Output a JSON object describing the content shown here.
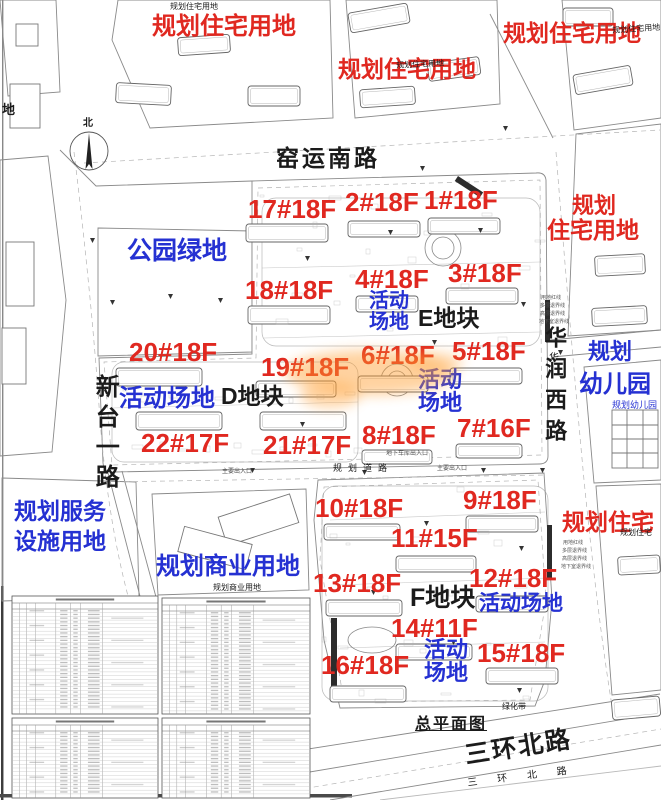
{
  "document": {
    "type": "site-plan",
    "title": "总平面图"
  },
  "colors": {
    "red": "#e02820",
    "blue": "#2531d2",
    "black": "#1b1b1b",
    "gray": "#555555",
    "orange_watermark": "#ff9d2e",
    "linework": "#8a8a8a"
  },
  "compass": {
    "label": "北"
  },
  "labels": [
    {
      "n": "land-use-residential-top-left",
      "t": "规划住宅用地",
      "x": 152,
      "y": 14,
      "s": 24,
      "c": "red"
    },
    {
      "n": "land-use-residential-top-center",
      "t": "规划住宅用地",
      "x": 338,
      "y": 57,
      "s": 23,
      "c": "red"
    },
    {
      "n": "land-use-residential-top-right",
      "t": "规划住宅用地",
      "x": 503,
      "y": 21,
      "s": 23,
      "c": "red"
    },
    {
      "n": "land-use-residential-right-line1",
      "t": "规划",
      "x": 572,
      "y": 194,
      "s": 22,
      "c": "red"
    },
    {
      "n": "land-use-residential-right-line2",
      "t": "住宅用地",
      "x": 547,
      "y": 218,
      "s": 23,
      "c": "red"
    },
    {
      "n": "land-use-residential-bottom-right",
      "t": "规划住宅",
      "x": 562,
      "y": 510,
      "s": 23,
      "c": "red"
    },
    {
      "n": "land-use-park-green",
      "t": "公园绿地",
      "x": 127,
      "y": 238,
      "s": 25,
      "c": "blue"
    },
    {
      "n": "activity-area-e-upper",
      "t": "活动\n场地",
      "x": 369,
      "y": 291,
      "s": 20,
      "c": "blue"
    },
    {
      "n": "activity-area-center",
      "t": "活动\n场地",
      "x": 418,
      "y": 368,
      "s": 22,
      "c": "blue"
    },
    {
      "n": "activity-area-d",
      "t": "活动场地",
      "x": 119,
      "y": 386,
      "s": 24,
      "c": "blue"
    },
    {
      "n": "planned-kindergarten-line1",
      "t": "规划",
      "x": 588,
      "y": 340,
      "s": 22,
      "c": "blue"
    },
    {
      "n": "planned-kindergarten-line2",
      "t": "幼儿园",
      "x": 579,
      "y": 372,
      "s": 24,
      "c": "blue"
    },
    {
      "n": "planned-kindergarten-small",
      "t": "规划幼儿园",
      "x": 612,
      "y": 401,
      "s": 9,
      "c": "blue",
      "w": false
    },
    {
      "n": "land-use-service-facilities",
      "t": "规划服务\n设施用地",
      "x": 14,
      "y": 496,
      "s": 23,
      "c": "blue",
      "lh": 30
    },
    {
      "n": "land-use-commercial",
      "t": "规划商业用地",
      "x": 156,
      "y": 554,
      "s": 24,
      "c": "blue"
    },
    {
      "n": "activity-area-f-right",
      "t": "活动场地",
      "x": 479,
      "y": 593,
      "s": 21,
      "c": "blue"
    },
    {
      "n": "activity-area-f-bottom",
      "t": "活动\n场地",
      "x": 424,
      "y": 638,
      "s": 22,
      "c": "blue"
    },
    {
      "n": "building-label-17",
      "t": "17#18F",
      "x": 248,
      "y": 196,
      "s": 26,
      "c": "red"
    },
    {
      "n": "building-label-2",
      "t": "2#18F",
      "x": 345,
      "y": 189,
      "s": 26,
      "c": "red"
    },
    {
      "n": "building-label-1",
      "t": "1#18F",
      "x": 424,
      "y": 187,
      "s": 26,
      "c": "red"
    },
    {
      "n": "building-label-18",
      "t": "18#18F",
      "x": 245,
      "y": 277,
      "s": 26,
      "c": "red"
    },
    {
      "n": "building-label-4",
      "t": "4#18F",
      "x": 355,
      "y": 266,
      "s": 26,
      "c": "red"
    },
    {
      "n": "building-label-3",
      "t": "3#18F",
      "x": 448,
      "y": 260,
      "s": 26,
      "c": "red"
    },
    {
      "n": "building-label-20",
      "t": "20#18F",
      "x": 129,
      "y": 339,
      "s": 26,
      "c": "red"
    },
    {
      "n": "building-label-19",
      "t": "19#18F",
      "x": 261,
      "y": 354,
      "s": 26,
      "c": "red"
    },
    {
      "n": "building-label-6",
      "t": "6#18F",
      "x": 361,
      "y": 342,
      "s": 26,
      "c": "red"
    },
    {
      "n": "building-label-5",
      "t": "5#18F",
      "x": 452,
      "y": 338,
      "s": 26,
      "c": "red"
    },
    {
      "n": "building-label-22",
      "t": "22#17F",
      "x": 141,
      "y": 430,
      "s": 26,
      "c": "red"
    },
    {
      "n": "building-label-21",
      "t": "21#17F",
      "x": 263,
      "y": 432,
      "s": 26,
      "c": "red"
    },
    {
      "n": "building-label-8",
      "t": "8#18F",
      "x": 362,
      "y": 422,
      "s": 26,
      "c": "red"
    },
    {
      "n": "building-label-7",
      "t": "7#16F",
      "x": 457,
      "y": 415,
      "s": 26,
      "c": "red"
    },
    {
      "n": "building-label-9",
      "t": "9#18F",
      "x": 463,
      "y": 487,
      "s": 26,
      "c": "red"
    },
    {
      "n": "building-label-10",
      "t": "10#18F",
      "x": 315,
      "y": 495,
      "s": 26,
      "c": "red"
    },
    {
      "n": "building-label-11",
      "t": "11#15F",
      "x": 391,
      "y": 525,
      "s": 26,
      "c": "red"
    },
    {
      "n": "building-label-12",
      "t": "12#18F",
      "x": 469,
      "y": 565,
      "s": 26,
      "c": "red"
    },
    {
      "n": "building-label-13",
      "t": "13#18F",
      "x": 313,
      "y": 570,
      "s": 26,
      "c": "red"
    },
    {
      "n": "building-label-14",
      "t": "14#11F",
      "x": 391,
      "y": 615,
      "s": 26,
      "c": "red"
    },
    {
      "n": "building-label-15",
      "t": "15#18F",
      "x": 477,
      "y": 640,
      "s": 26,
      "c": "red"
    },
    {
      "n": "building-label-16",
      "t": "16#18F",
      "x": 321,
      "y": 652,
      "s": 26,
      "c": "red"
    },
    {
      "n": "road-yaoyun-south",
      "t": "窑运南路",
      "x": 276,
      "y": 146,
      "s": 23,
      "c": "black",
      "ls": 3
    },
    {
      "n": "block-e",
      "t": "E地块",
      "x": 418,
      "y": 306,
      "s": 23,
      "c": "black"
    },
    {
      "n": "block-d",
      "t": "D地块",
      "x": 221,
      "y": 384,
      "s": 23,
      "c": "black"
    },
    {
      "n": "block-f",
      "t": "F地块",
      "x": 410,
      "y": 585,
      "s": 25,
      "c": "black"
    },
    {
      "n": "road-xintai-first",
      "t": "新台一路",
      "x": 92,
      "y": 374,
      "s": 24,
      "c": "black",
      "vert": true,
      "ls": 6
    },
    {
      "n": "road-huarun-west",
      "t": "华润西路",
      "x": 543,
      "y": 326,
      "s": 22,
      "c": "black",
      "vert": true,
      "ls": 9
    },
    {
      "n": "road-huarun-west-small",
      "t": "华",
      "x": 549,
      "y": 354,
      "s": 10,
      "c": "black",
      "w": false
    },
    {
      "n": "road-sanhuan-north",
      "t": "三环北路",
      "x": 463,
      "y": 743,
      "s": 25,
      "c": "black",
      "ls": 2,
      "rot": -9
    },
    {
      "n": "road-sanhuan-north-small",
      "t": "三环北路",
      "x": 467,
      "y": 779,
      "s": 10,
      "c": "black",
      "ls": 20,
      "rot": -7,
      "w": false
    },
    {
      "n": "plan-title",
      "t": "总平面图",
      "x": 415,
      "y": 717,
      "s": 16,
      "c": "black",
      "ls": 2,
      "u": true
    },
    {
      "n": "green-belt",
      "t": "绿化带",
      "x": 502,
      "y": 703,
      "s": 8,
      "c": "black",
      "w": false
    },
    {
      "n": "road-planned-label",
      "t": "规划道路",
      "x": 333,
      "y": 464,
      "s": 9,
      "c": "black",
      "ls": 6,
      "w": false
    },
    {
      "n": "commercial-small-label",
      "t": "规划商业用地",
      "x": 213,
      "y": 584,
      "s": 8,
      "c": "black",
      "w": false
    },
    {
      "n": "residential-small-top",
      "t": "规划住宅用地",
      "x": 170,
      "y": 3,
      "s": 8,
      "c": "black",
      "w": false
    },
    {
      "n": "residential-small-top-center",
      "t": "规划住宅用地",
      "x": 396,
      "y": 62,
      "s": 8,
      "c": "black",
      "w": false,
      "rot": -3
    },
    {
      "n": "residential-small-top-right",
      "t": "规划住宅用地",
      "x": 612,
      "y": 27,
      "s": 8,
      "c": "black",
      "w": false,
      "rot": -4
    },
    {
      "n": "residential-small-right",
      "t": "规划住宅",
      "x": 620,
      "y": 529,
      "s": 8,
      "c": "black",
      "w": false
    },
    {
      "n": "cut-label-left",
      "t": "地",
      "x": 2,
      "y": 103,
      "s": 13,
      "c": "black"
    },
    {
      "n": "entrance-annotation-1",
      "t": "主要出入口",
      "x": 437,
      "y": 466,
      "s": 6,
      "c": "gray",
      "w": false
    },
    {
      "n": "entrance-annotation-2",
      "t": "地下车库出入口",
      "x": 386,
      "y": 451,
      "s": 6,
      "c": "gray",
      "w": false
    },
    {
      "n": "entrance-annotation-3",
      "t": "主要出入口",
      "x": 222,
      "y": 469,
      "s": 6,
      "c": "gray",
      "w": false
    },
    {
      "n": "redline-annotation-1",
      "t": "用地红线",
      "x": 541,
      "y": 296,
      "s": 5,
      "c": "gray",
      "w": false
    },
    {
      "n": "redline-annotation-2",
      "t": "多层退界线",
      "x": 540,
      "y": 304,
      "s": 5,
      "c": "gray",
      "w": false
    },
    {
      "n": "redline-annotation-3",
      "t": "高层退界线",
      "x": 540,
      "y": 312,
      "s": 5,
      "c": "gray",
      "w": false
    },
    {
      "n": "redline-annotation-4",
      "t": "地下室退界线",
      "x": 539,
      "y": 320,
      "s": 5,
      "c": "gray",
      "w": false
    },
    {
      "n": "redline-annotation-5",
      "t": "用地红线",
      "x": 563,
      "y": 541,
      "s": 5,
      "c": "gray",
      "w": false
    },
    {
      "n": "redline-annotation-6",
      "t": "多层退界线",
      "x": 562,
      "y": 549,
      "s": 5,
      "c": "gray",
      "w": false
    },
    {
      "n": "redline-annotation-7",
      "t": "高层退界线",
      "x": 562,
      "y": 557,
      "s": 5,
      "c": "gray",
      "w": false
    },
    {
      "n": "redline-annotation-8",
      "t": "地下室退界线",
      "x": 561,
      "y": 565,
      "s": 5,
      "c": "gray",
      "w": false
    }
  ]
}
